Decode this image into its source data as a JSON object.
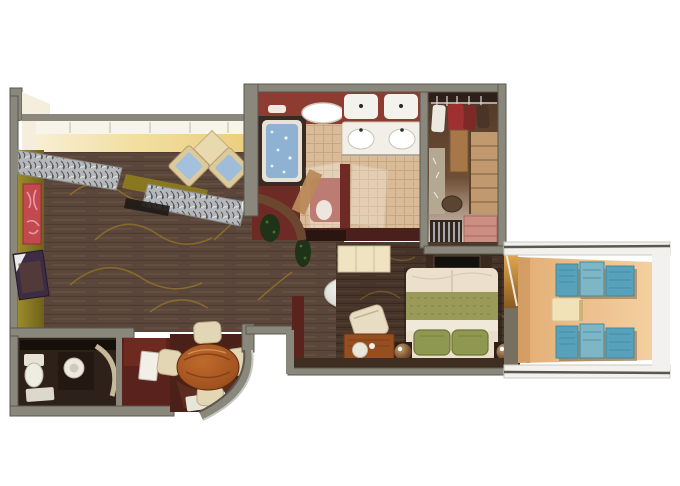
{
  "meta": {
    "title": "3D rendered floor plan of a suite with balcony",
    "type": "floor-plan",
    "background": "#ffffff",
    "visible_text": []
  },
  "palette": {
    "wood": "#5a463a",
    "woodLine": "#6f5946",
    "woodDark": "#463428",
    "goldSwirl": "#96762a",
    "windowBand": "#f7f4ea",
    "wallCream": "#f6ecca",
    "wallGold": "#ecce7e",
    "oliveWall": "#8a7a20",
    "oliveDark": "#6e611a",
    "artRed": "#c4494e",
    "artPink": "#e8a4b2",
    "sofaSilver": "#b4b8bc",
    "sofaDark": "#3c3c38",
    "chairBeige": "#dcc99c",
    "cushionBlue": "#a3c0dc",
    "diamondTable": "#e9d9ae",
    "grayWall": "#8a877c",
    "grayWallDark": "#5a574e",
    "whiteWall": "#f2f1ed",
    "maroon": "#6e2a24",
    "maroonLight": "#8e3c32",
    "maroonDark": "#49201b",
    "tile": "#d9bb98",
    "tileLine": "#bf9e7a",
    "tubBlue": "#8fb2d2",
    "tubRim": "#e8e2d6",
    "closetBrown": "#5d4330",
    "shelfTan": "#c09a6e",
    "drawerPink": "#cc8d82",
    "bedCream": "#ece0cc",
    "bedGreen": "#9a9a58",
    "pillowGreen": "#8f9850",
    "lampBrown": "#7a5434",
    "deskWood": "#954e20",
    "creamCabinet": "#efe3c2",
    "diningFloor": "#4a2018",
    "tableWood": "#a0521e",
    "chairCream": "#e2d6b4",
    "vestibuleRed": "#5a221c",
    "darkBathFloor": "#2e211a",
    "balconyFloor": "#edbf8c",
    "balconyFloorLight": "#f4cf9f",
    "loungerTeal": "#57a2ba",
    "loungerTealLight": "#7eb6c6",
    "loungerTealDark": "#3f8aa2",
    "curtainGold": "#cf9136",
    "plantGreen": "#1e3318",
    "plantLight": "#466f2e",
    "ovalTable": "#d8d8d2"
  },
  "rooms": [
    {
      "id": "living-room",
      "name": "Living room",
      "furniture": [
        "sectional-sofa-left",
        "sectional-sofa-right",
        "console-behind-sofa",
        "armchair-left",
        "armchair-right",
        "diamond-cocktail-table",
        "sphere-floor-lamp",
        "red-wall-art",
        "framed-picture",
        "window-wall",
        "oval-coffee-table"
      ]
    },
    {
      "id": "dining-nook",
      "name": "Dining nook",
      "furniture": [
        "oval-dining-table",
        "dining-chair-top",
        "dining-chair-right",
        "dining-chair-bottom",
        "dining-chair-left",
        "sideboard",
        "curved-outer-wall",
        "floor-mat"
      ]
    },
    {
      "id": "guest-bathroom",
      "name": "Guest bathroom",
      "furniture": [
        "toilet",
        "round-sink",
        "shower-glass",
        "bath-mat",
        "mirror-strip"
      ]
    },
    {
      "id": "entry-vestibule",
      "name": "Entry vestibule",
      "furniture": [
        "entry-door"
      ]
    },
    {
      "id": "master-bathroom",
      "name": "Master bathroom",
      "furniture": [
        "whirlpool-tub",
        "ceiling-light",
        "wall-light",
        "vanity-mirror",
        "double-sink-counter",
        "glass-partition-left",
        "glass-partition-right",
        "toilet-seat",
        "tile-floor",
        "open-door",
        "planter"
      ]
    },
    {
      "id": "walk-in-closet",
      "name": "Walk-in closet",
      "furniture": [
        "hanging-rail",
        "garments",
        "shelving-unit",
        "mid-shelves",
        "ottoman-bench",
        "drawer-unit",
        "rod-rack",
        "mirror-panel"
      ]
    },
    {
      "id": "master-bedroom",
      "name": "Master bedroom",
      "furniture": [
        "double-bed",
        "green-runner",
        "pillows",
        "nightstand-lamp-left",
        "nightstand-lamp-right",
        "tv-cabinet",
        "minibar-cabinet",
        "desk",
        "desk-chair",
        "corner-plant",
        "balcony-curtain"
      ]
    },
    {
      "id": "balcony",
      "name": "Balcony",
      "furniture": [
        "lounge-chair-top",
        "lounge-chair-bottom",
        "side-table"
      ]
    }
  ]
}
